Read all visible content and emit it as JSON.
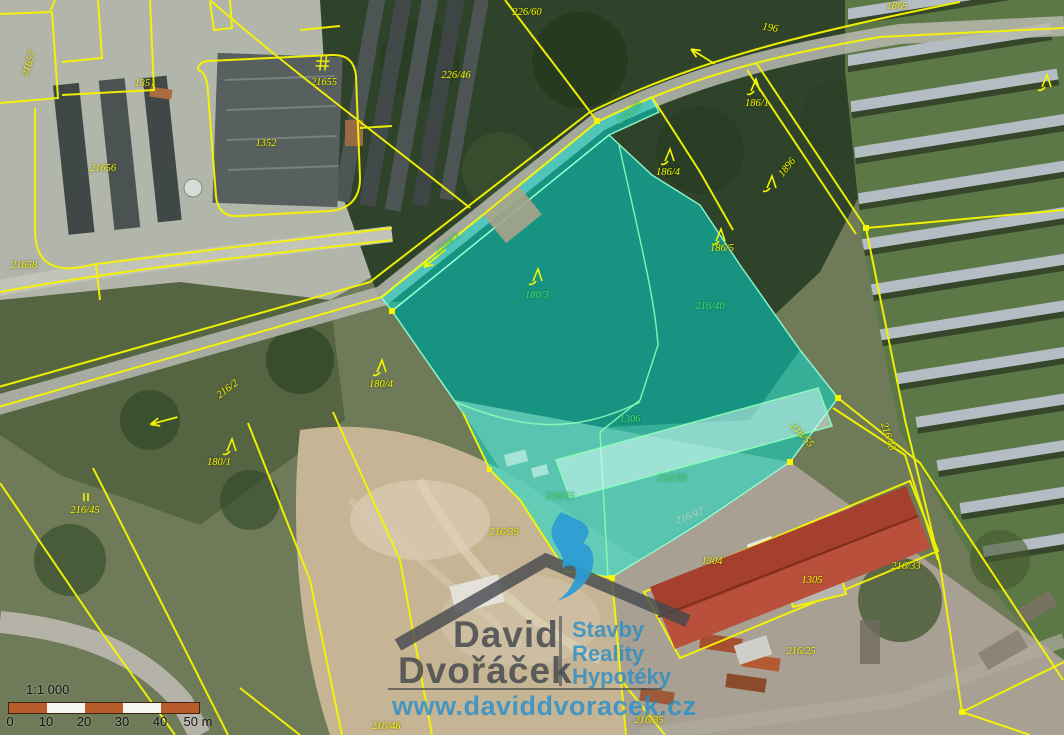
{
  "map": {
    "scale": {
      "ratio": "1:1 000",
      "ticks": [
        {
          "label": "0",
          "x": 10
        },
        {
          "label": "10",
          "x": 46
        },
        {
          "label": "20",
          "x": 84
        },
        {
          "label": "30",
          "x": 122
        },
        {
          "label": "40",
          "x": 160
        },
        {
          "label": "50 m",
          "x": 198
        }
      ],
      "bar_colors": [
        "#b85c2c",
        "#f7f5ef",
        "#b85c2c",
        "#f7f5ef",
        "#b85c2c"
      ]
    },
    "watermark": {
      "name_line1": "David",
      "name_line2": "Dvořáček",
      "tagline1": "Stavby",
      "tagline2": "Reality",
      "tagline3": "Hypotéky",
      "url": "www.daviddvoracek.cz"
    },
    "colors": {
      "parcel_line_yellow": "#f6f600",
      "highlight_cyan": "#00e4d7",
      "highlight_label_green": "#46df66",
      "watermark_blue": "#2b9cd6",
      "watermark_gray": "#45484d",
      "building_red": "#b8503c",
      "scalebar_orange": "#b85c2c"
    },
    "parcel_labels": [
      {
        "text": "21657",
        "x": 30,
        "y": 64,
        "rot": -72,
        "kind": "yellow"
      },
      {
        "text": "1351",
        "x": 145,
        "y": 84,
        "rot": 0,
        "kind": "yellow"
      },
      {
        "text": "21655",
        "x": 324,
        "y": 83,
        "rot": 0,
        "kind": "yellow"
      },
      {
        "text": "1352",
        "x": 266,
        "y": 144,
        "rot": 0,
        "kind": "yellow"
      },
      {
        "text": "21656",
        "x": 103,
        "y": 169,
        "rot": 0,
        "kind": "yellow"
      },
      {
        "text": "21658",
        "x": 24,
        "y": 266,
        "rot": 0,
        "kind": "yellow"
      },
      {
        "text": "226/60",
        "x": 527,
        "y": 13,
        "rot": 0,
        "kind": "yellow"
      },
      {
        "text": "226/46",
        "x": 456,
        "y": 76,
        "rot": 0,
        "kind": "yellow"
      },
      {
        "text": "196",
        "x": 770,
        "y": 29,
        "rot": 10,
        "kind": "yellow"
      },
      {
        "text": "1865",
        "x": 897,
        "y": 7,
        "rot": 0,
        "kind": "yellow"
      },
      {
        "text": "186/1",
        "x": 757,
        "y": 104,
        "rot": 0,
        "kind": "yellow"
      },
      {
        "text": "186/4",
        "x": 668,
        "y": 173,
        "rot": 0,
        "kind": "yellow"
      },
      {
        "text": "1896",
        "x": 788,
        "y": 168,
        "rot": -52,
        "kind": "yellow"
      },
      {
        "text": "186/5",
        "x": 722,
        "y": 249,
        "rot": 0,
        "kind": "yellow"
      },
      {
        "text": "216/29",
        "x": 630,
        "y": 114,
        "rot": -38,
        "kind": "green"
      },
      {
        "text": "2164/1",
        "x": 448,
        "y": 244,
        "rot": -39,
        "kind": "green"
      },
      {
        "text": "180/3",
        "x": 537,
        "y": 296,
        "rot": 0,
        "kind": "green"
      },
      {
        "text": "216/40",
        "x": 710,
        "y": 307,
        "rot": 0,
        "kind": "green"
      },
      {
        "text": "216/2",
        "x": 228,
        "y": 390,
        "rot": -37,
        "kind": "yellow"
      },
      {
        "text": "180/4",
        "x": 381,
        "y": 385,
        "rot": 0,
        "kind": "yellow"
      },
      {
        "text": "180/1",
        "x": 219,
        "y": 463,
        "rot": 0,
        "kind": "yellow"
      },
      {
        "text": "216/45",
        "x": 85,
        "y": 511,
        "rot": 0,
        "kind": "yellow"
      },
      {
        "text": "1306",
        "x": 630,
        "y": 420,
        "rot": 0,
        "kind": "green"
      },
      {
        "text": "216/65",
        "x": 560,
        "y": 497,
        "rot": 0,
        "kind": "green"
      },
      {
        "text": "216/30",
        "x": 672,
        "y": 479,
        "rot": 0,
        "kind": "green"
      },
      {
        "text": "216/39",
        "x": 504,
        "y": 533,
        "rot": 0,
        "kind": "yellow"
      },
      {
        "text": "216/47",
        "x": 690,
        "y": 517,
        "rot": -21,
        "kind": "faint"
      },
      {
        "text": "216/55",
        "x": 801,
        "y": 436,
        "rot": 47,
        "kind": "yellow"
      },
      {
        "text": "216/43",
        "x": 887,
        "y": 437,
        "rot": 72,
        "kind": "yellow"
      },
      {
        "text": "1304",
        "x": 712,
        "y": 562,
        "rot": 0,
        "kind": "yellow"
      },
      {
        "text": "1305",
        "x": 812,
        "y": 581,
        "rot": 0,
        "kind": "yellow"
      },
      {
        "text": "216/33",
        "x": 906,
        "y": 567,
        "rot": 0,
        "kind": "yellow"
      },
      {
        "text": "216/25",
        "x": 801,
        "y": 652,
        "rot": 0,
        "kind": "yellow"
      },
      {
        "text": "216/35",
        "x": 649,
        "y": 721,
        "rot": 0,
        "kind": "yellow"
      },
      {
        "text": "216/46",
        "x": 386,
        "y": 727,
        "rot": 0,
        "kind": "yellow"
      }
    ],
    "map_symbols": [
      {
        "type": "tree",
        "x": 756,
        "y": 86,
        "rot": 0
      },
      {
        "type": "tree",
        "x": 670,
        "y": 156,
        "rot": 0
      },
      {
        "type": "tree",
        "x": 772,
        "y": 183,
        "rot": 0
      },
      {
        "type": "tree",
        "x": 721,
        "y": 236,
        "rot": 0
      },
      {
        "type": "tree",
        "x": 1047,
        "y": 82,
        "rot": 0
      },
      {
        "type": "tree",
        "x": 538,
        "y": 276,
        "rot": 0
      },
      {
        "type": "tree",
        "x": 382,
        "y": 367,
        "rot": 0
      },
      {
        "type": "tree",
        "x": 232,
        "y": 446,
        "rot": 0
      },
      {
        "type": "arrow",
        "x": 434,
        "y": 259,
        "rot": -39
      },
      {
        "type": "arrow",
        "x": 163,
        "y": 421,
        "rot": -15
      },
      {
        "type": "arrow",
        "x": 702,
        "y": 56,
        "rot": 32
      },
      {
        "type": "hash",
        "x": 322,
        "y": 64,
        "rot": 10
      },
      {
        "type": "parallel",
        "x": 86,
        "y": 497,
        "rot": 0
      }
    ]
  }
}
